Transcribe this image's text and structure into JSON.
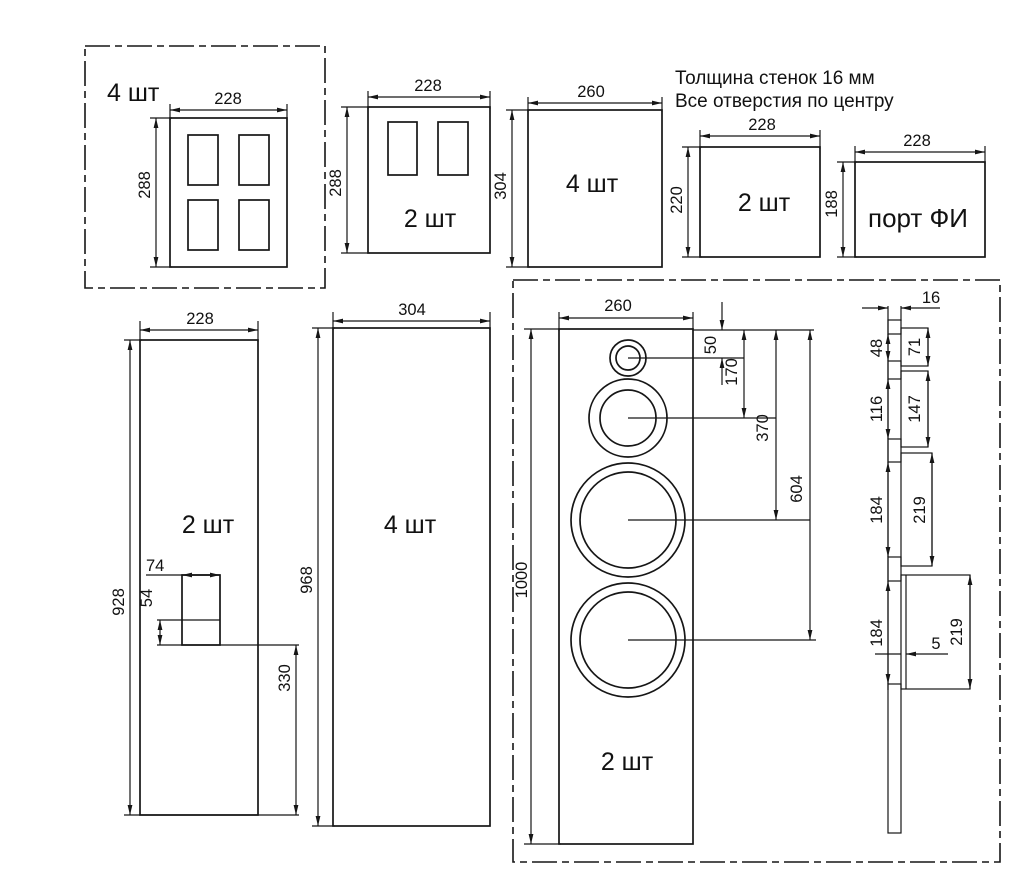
{
  "note": {
    "line1": "Толщина стенок 16 мм",
    "line2": "Все отверстия по центру"
  },
  "panels": {
    "p1": {
      "qty": "4 шт",
      "w": "228",
      "h": "288"
    },
    "p2": {
      "qty": "2 шт",
      "w": "228",
      "h": "288"
    },
    "p3": {
      "qty": "4 шт",
      "w": "260",
      "h": "304"
    },
    "p4": {
      "qty": "2 шт",
      "w": "228",
      "h": "220"
    },
    "p5": {
      "label": "порт ФИ",
      "w": "228",
      "h": "188"
    },
    "side": {
      "qty": "2 шт",
      "w": "228",
      "h": "928",
      "cut_w": "74",
      "cut_h": "54",
      "cut_from_bottom": "330"
    },
    "side2": {
      "qty": "4 шт",
      "w": "304",
      "h": "968"
    },
    "front": {
      "qty": "2 шт",
      "w": "260",
      "h": "1000",
      "tweeter_offset": "50",
      "mid_offset": "170",
      "woofer1_offset": "370",
      "woofer2_offset": "604"
    },
    "section": {
      "thickness": "16",
      "hole1": "48",
      "hole2": "116",
      "hole3": "184",
      "hole4": "184",
      "recess1": "71",
      "recess2": "147",
      "recess3": "219",
      "recess4": "219",
      "recess_depth": "5"
    }
  }
}
